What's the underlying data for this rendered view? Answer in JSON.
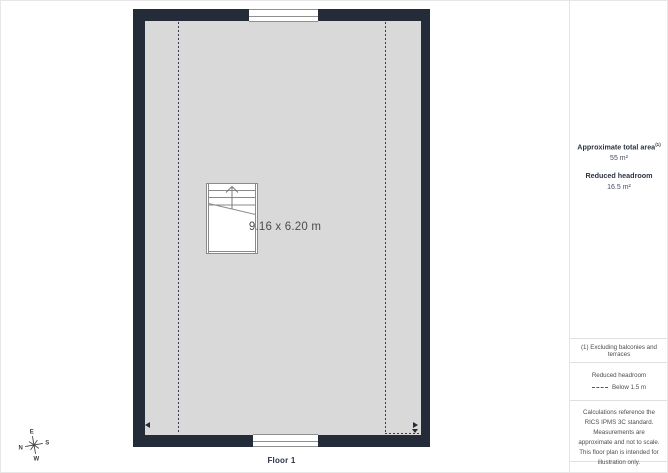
{
  "plan": {
    "room_dimensions": "9.16 x 6.20 m",
    "floor_label": "Floor 1"
  },
  "compass": {
    "n": "N",
    "e": "E",
    "s": "S",
    "w": "W"
  },
  "sidebar": {
    "total_area_label": "Approximate total area",
    "total_area_footnote_marker": "(1)",
    "total_area_value": "55 m²",
    "reduced_headroom_label": "Reduced headroom",
    "reduced_headroom_value": "16.5 m²",
    "footnote": "(1) Excluding balconies and terraces",
    "legend_heading": "Reduced headroom",
    "legend_item_label": "Below 1.5 m",
    "disclaimer": "Calculations reference the RICS IPMS 3C standard. Measurements are approximate and not to scale. This floor plan is intended for illustration only.",
    "brand_name": "GIRAFFE",
    "brand_suffix": "360"
  },
  "colors": {
    "wall": "#242c39",
    "floor": "#d9d9d9",
    "stair_outline": "#8a8a8a",
    "divider": "#e0e0e0",
    "heading_text": "#2c3545",
    "note_text": "#4d4d4d"
  }
}
